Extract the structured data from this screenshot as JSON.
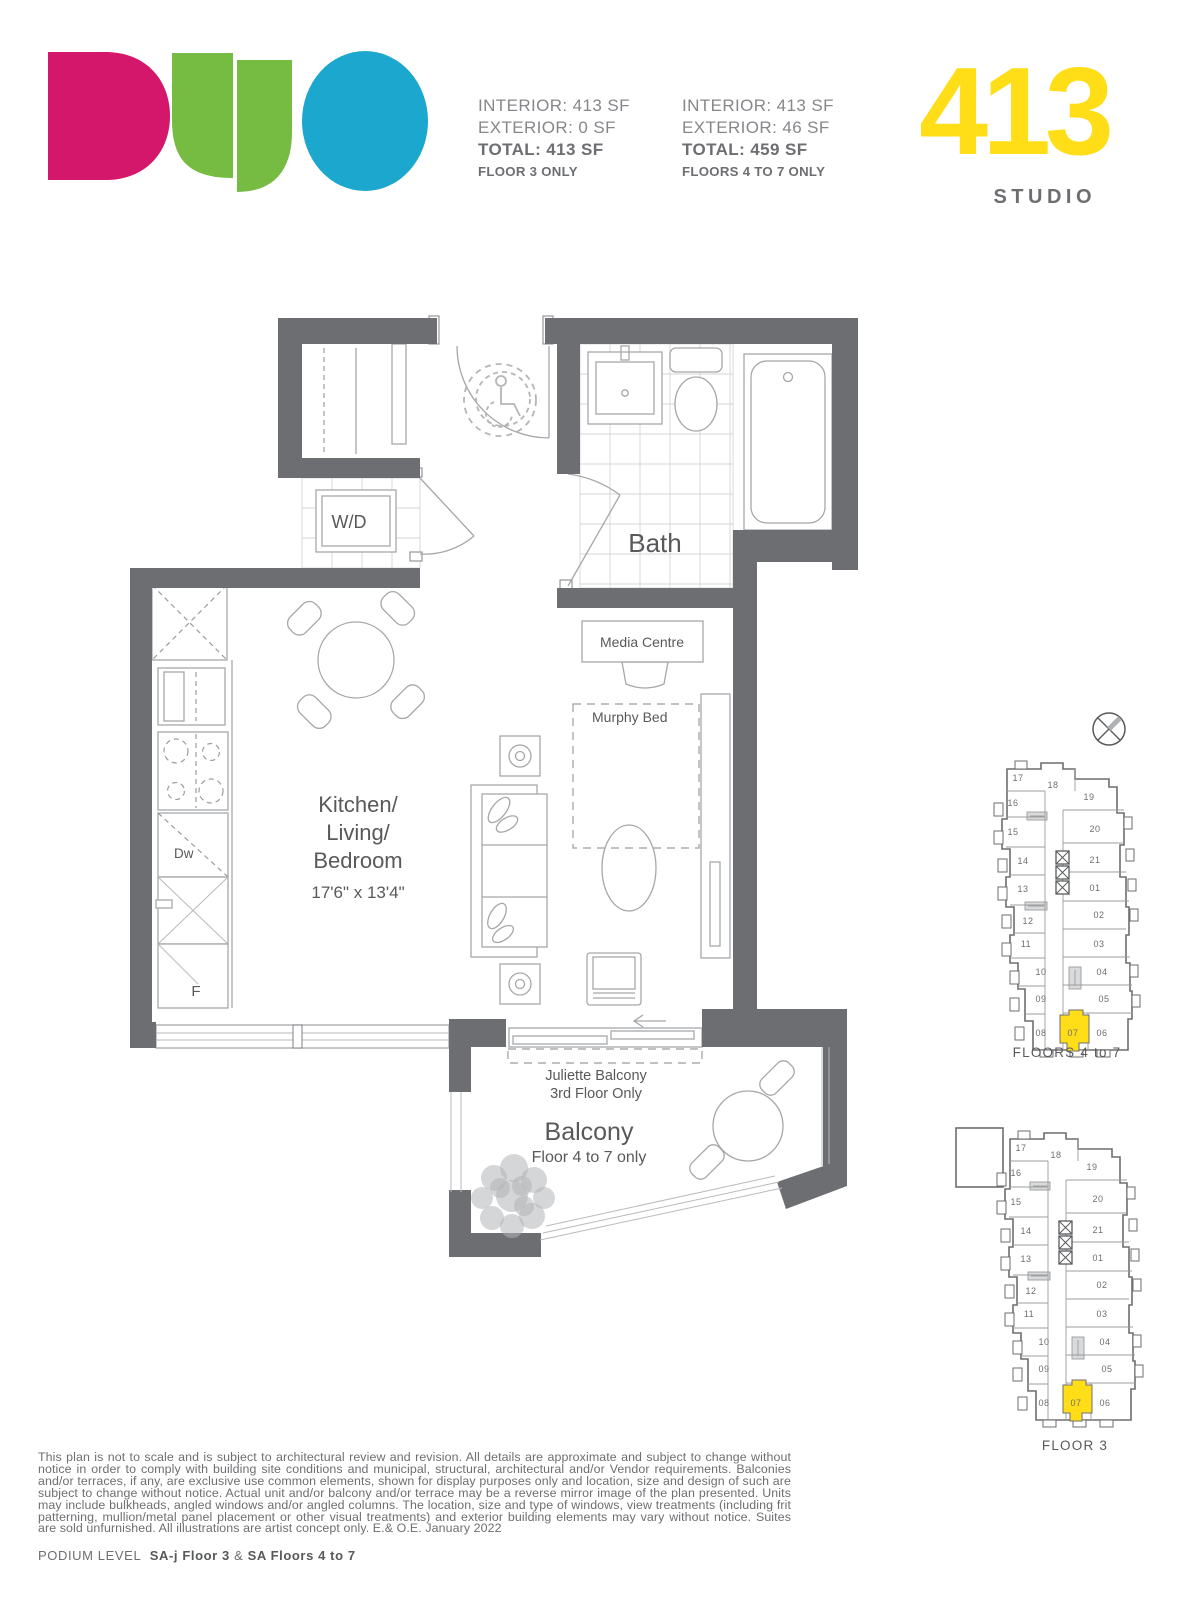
{
  "header": {
    "stats": [
      {
        "interior": "INTERIOR: 413 SF",
        "exterior": "EXTERIOR: 0 SF",
        "total": "TOTAL: 413 SF",
        "floors": "FLOOR 3 ONLY"
      },
      {
        "interior": "INTERIOR: 413 SF",
        "exterior": "EXTERIOR: 46 SF",
        "total": "TOTAL: 459 SF",
        "floors": "FLOORS 4 TO 7 ONLY"
      }
    ],
    "unit_number": "413",
    "unit_type": "STUDIO"
  },
  "logo": {
    "name": "DUO",
    "colors": {
      "d": "#d4176a",
      "u": "#76bc43",
      "o": "#1ca7ce"
    }
  },
  "plan": {
    "labels": {
      "wd": "W/D",
      "bath": "Bath",
      "media_centre": "Media Centre",
      "murphy_bed": "Murphy Bed",
      "room_line1": "Kitchen/",
      "room_line2": "Living/",
      "room_line3": "Bedroom",
      "room_dims": "17'6\" x 13'4\"",
      "dishwasher": "Dw",
      "fridge": "F",
      "juliette_line1": "Juliette Balcony",
      "juliette_line2": "3rd Floor Only",
      "balcony": "Balcony",
      "balcony_sub": "Floor 4 to 7 only"
    },
    "colors": {
      "wall": "#6d6e71",
      "accent": "#ffde17"
    }
  },
  "keyplans": [
    {
      "label": "FLOORS 4 to 7",
      "highlight": "07",
      "units": [
        "17",
        "16",
        "18",
        "19",
        "15",
        "20",
        "14",
        "21",
        "13",
        "01",
        "12",
        "02",
        "11",
        "03",
        "10",
        "04",
        "09",
        "05",
        "08",
        "07",
        "06"
      ]
    },
    {
      "label": "FLOOR 3",
      "highlight": "07",
      "units": [
        "17",
        "16",
        "18",
        "19",
        "15",
        "20",
        "14",
        "21",
        "13",
        "01",
        "12",
        "02",
        "11",
        "03",
        "10",
        "04",
        "09",
        "05",
        "08",
        "07",
        "06"
      ]
    }
  ],
  "footer": {
    "disclaimer": "This plan is not to scale and is subject to architectural review and revision. All details are approximate and subject to change without notice in order to comply with building site conditions and municipal, structural, architectural and/or Vendor requirements. Balconies and/or terraces, if any, are exclusive use common elements, shown for display purposes only and location, size and design of such are subject to change without notice. Actual unit and/or balcony and/or terrace may be a reverse mirror image of the plan presented. Units may include bulkheads, angled windows and/or angled columns. The location, size and type of windows, view treatments (including frit patterning, mullion/metal panel placement or other visual treatments) and exterior building elements may vary without notice. Suites are sold unfurnished. All illustrations are artist concept only. E.& O.E. January 2022",
    "podium_prefix": "PODIUM LEVEL",
    "podium_plan1": "SA-j Floor 3",
    "podium_amp": "&",
    "podium_plan2": "SA Floors 4 to 7"
  }
}
